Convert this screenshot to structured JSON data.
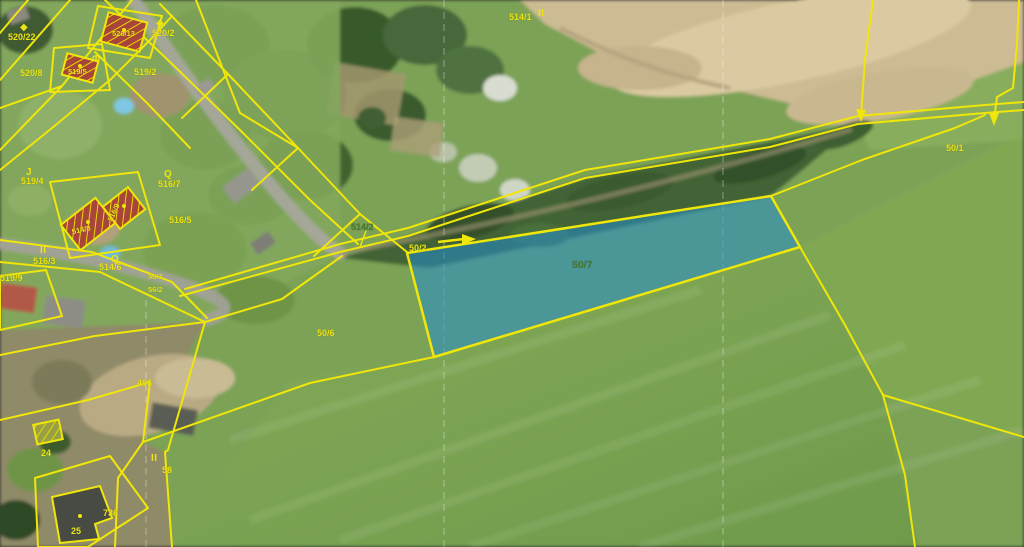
{
  "map_overlay": {
    "type": "cadastral-parcel-map-over-aerial-photo",
    "highlighted_parcel_number": "50/7",
    "colors": {
      "boundary_yellow": "#f0e60a",
      "label_yellow": "#ede412",
      "label_green": "#4a7c2f",
      "highlight_fill": "rgba(35,140,205,0.55)",
      "building_hatch_red": "#a8453a",
      "grid_white": "rgba(255,255,255,0.38)"
    }
  },
  "labels": [
    {
      "text": "520/22",
      "color": "#ede412"
    },
    {
      "text": "520/8",
      "color": "#ede412"
    },
    {
      "text": "520/13",
      "color": "#ede412"
    },
    {
      "text": "519/5",
      "color": "#ede412"
    },
    {
      "text": "520/2",
      "color": "#ede412"
    },
    {
      "text": "519/2",
      "color": "#ede412"
    },
    {
      "text": "519/4",
      "color": "#ede412"
    },
    {
      "text": "516/7",
      "color": "#ede412"
    },
    {
      "text": "516/5",
      "color": "#ede412"
    },
    {
      "text": "516/3",
      "color": "#ede412"
    },
    {
      "text": "519/9",
      "color": "#ede412"
    },
    {
      "text": "514/8",
      "color": "#ede412"
    },
    {
      "text": "516/9",
      "color": "#ede412"
    },
    {
      "text": "514/6",
      "color": "#ede412"
    },
    {
      "text": "56/3",
      "color": "#ede412"
    },
    {
      "text": "56/2",
      "color": "#ede412"
    },
    {
      "text": "514/1",
      "color": "#ede412"
    },
    {
      "text": "514/2",
      "color": "#4a7c2f"
    },
    {
      "text": "50/2",
      "color": "#ede412"
    },
    {
      "text": "50/7",
      "color": "#4a7c2f"
    },
    {
      "text": "50/6",
      "color": "#ede412"
    },
    {
      "text": "50/1",
      "color": "#ede412"
    },
    {
      "text": "496",
      "color": "#ede412"
    },
    {
      "text": "24",
      "color": "#ede412"
    },
    {
      "text": "58",
      "color": "#ede412"
    },
    {
      "text": "736",
      "color": "#ede412"
    },
    {
      "text": "25",
      "color": "#ede412"
    }
  ],
  "symbols": [
    {
      "glyph": "II"
    },
    {
      "glyph": "II"
    },
    {
      "glyph": "II"
    },
    {
      "glyph": "J"
    },
    {
      "glyph": "Q"
    },
    {
      "glyph": "Q"
    },
    {
      "glyph": "◆"
    },
    {
      "glyph": "◆"
    },
    {
      "glyph": "Φ"
    }
  ]
}
